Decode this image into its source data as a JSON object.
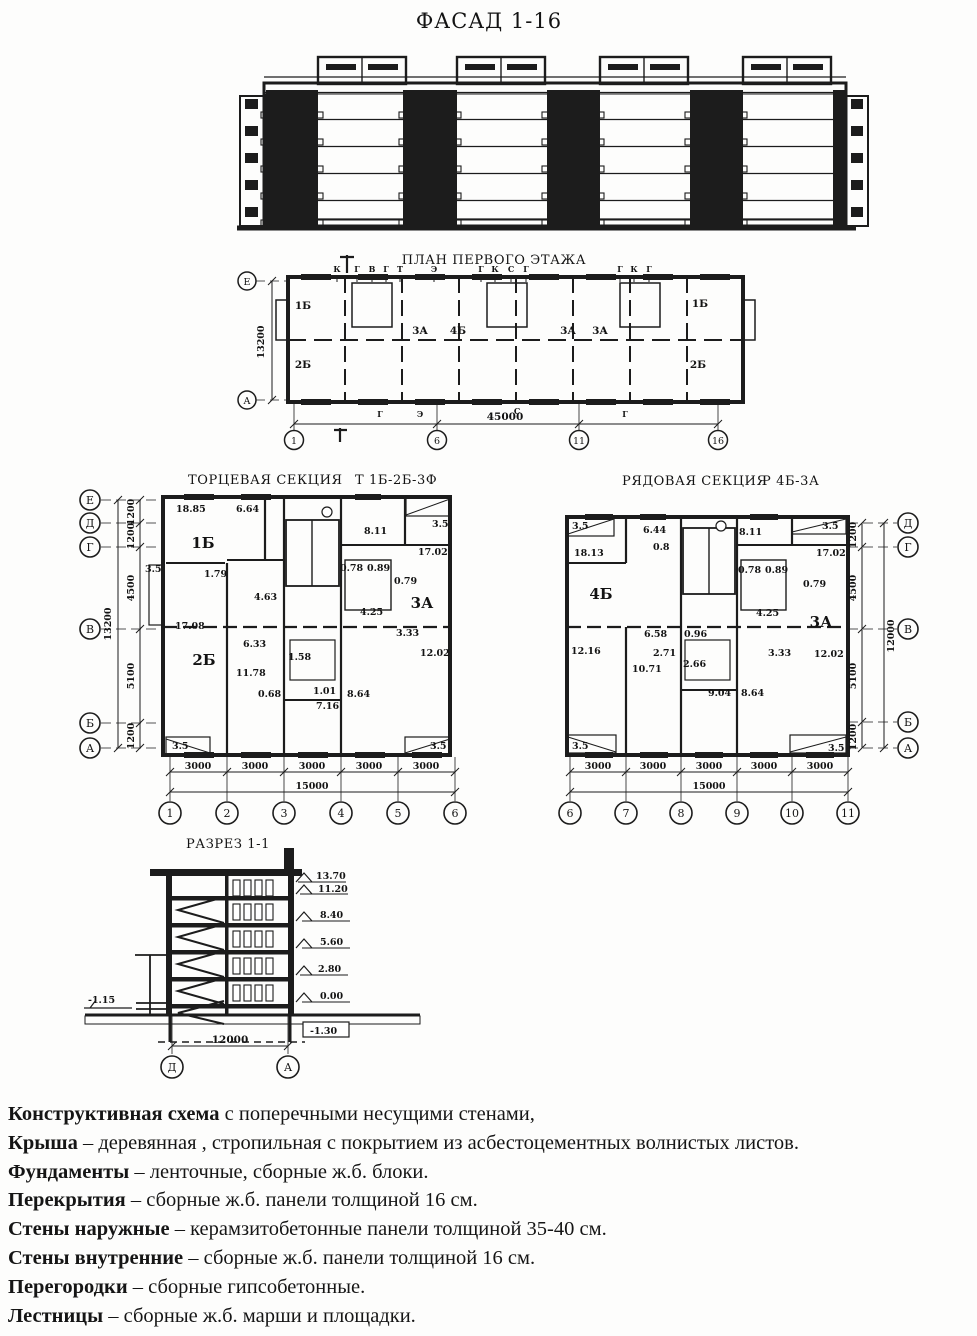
{
  "facade": {
    "title": "ФАСАД 1-16"
  },
  "plan": {
    "title": "ПЛАН ПЕРВОГО ЭТАЖА",
    "axis_left": [
      "Е",
      "А"
    ],
    "axis_bottom": [
      "1",
      "6",
      "11",
      "16"
    ],
    "dim_height": "13200",
    "dim_width": "45000",
    "rooms": [
      "1Б",
      "2Б",
      "3А",
      "4Б",
      "3А",
      "3А",
      "1Б",
      "2Б"
    ],
    "top_marks": [
      "К",
      "Г",
      "В",
      "Г",
      "Т",
      "Э",
      "Г",
      "К",
      "С",
      "Г",
      "Г",
      "К",
      "Г"
    ],
    "bottom_marks": [
      "Г",
      "Э",
      "С",
      "Г"
    ]
  },
  "end_section": {
    "title": "ТОРЦЕВАЯ СЕКЦИЯ",
    "code": "Т 1Б-2Б-3Ф",
    "axes_left": [
      "Е",
      "Д",
      "Г",
      "В",
      "Б",
      "А"
    ],
    "axes_bottom": [
      "1",
      "2",
      "3",
      "4",
      "5",
      "6"
    ],
    "dims_left": [
      "1200",
      "1200",
      "4500",
      "5100",
      "1200"
    ],
    "dim_left_total": "13200",
    "dims_bottom": [
      "3000",
      "3000",
      "3000",
      "3000",
      "3000"
    ],
    "dim_bottom_total": "15000",
    "rooms": [
      "1Б",
      "2Б",
      "3А"
    ],
    "areas": [
      "18.85",
      "6.64",
      "8.11",
      "3.5",
      "17.02",
      "1.79",
      "4.63",
      "0.78",
      "0.89",
      "0.79",
      "4.25",
      "3.33",
      "3.5",
      "17.08",
      "6.33",
      "1.58",
      "11.78",
      "0.68",
      "1.01",
      "7.16",
      "8.64",
      "12.02",
      "3.5",
      "3.5"
    ]
  },
  "row_section": {
    "title": "РЯДОВАЯ СЕКЦИЯ",
    "code": "Р 4Б-3А",
    "axes_right": [
      "Д",
      "Г",
      "В",
      "Б",
      "А"
    ],
    "axes_bottom": [
      "6",
      "7",
      "8",
      "9",
      "10",
      "11"
    ],
    "dims_right": [
      "1200",
      "4500",
      "5100",
      "1200"
    ],
    "dim_right_total": "12000",
    "dims_bottom": [
      "3000",
      "3000",
      "3000",
      "3000",
      "3000"
    ],
    "dim_bottom_total": "15000",
    "rooms": [
      "4Б",
      "3А"
    ],
    "areas": [
      "3.5",
      "18.13",
      "6.44",
      "0.8",
      "8.11",
      "3.5",
      "17.02",
      "0.78",
      "0.89",
      "0.79",
      "4.25",
      "12.16",
      "6.58",
      "2.71",
      "10.71",
      "0.96",
      "2.66",
      "9.04",
      "8.64",
      "3.33",
      "12.02",
      "3.5",
      "3.5"
    ]
  },
  "section": {
    "title": "РАЗРЕЗ 1-1",
    "elevations": [
      "13.70",
      "11.20",
      "8.40",
      "5.60",
      "2.80",
      "0.00"
    ],
    "pit_mark": "-1.30",
    "ground_mark": "-1.15",
    "dim_width": "12000",
    "axes_bottom": [
      "Д",
      "А"
    ]
  },
  "notes": [
    {
      "term": "Конструктивная схема",
      "rest": " с поперечными несущими стенами,"
    },
    {
      "term": "Крыша",
      "rest": " – деревянная , стропильная с покрытием из асбестоцементных волнистых листов."
    },
    {
      "term": "Фундаменты",
      "rest": " – ленточные, сборные ж.б. блоки."
    },
    {
      "term": "Перекрытия",
      "rest": " – сборные ж.б. панели толщиной 16 см."
    },
    {
      "term": "Стены наружные",
      "rest": " – керамзитобетонные панели толщиной 35-40 см."
    },
    {
      "term": "Стены внутренние",
      "rest": " – сборные ж.б. панели толщиной 16 см."
    },
    {
      "term": "Перегородки",
      "rest": " – сборные гипсобетонные."
    },
    {
      "term": "Лестницы",
      "rest": " – сборные ж.б. марши и площадки."
    }
  ]
}
